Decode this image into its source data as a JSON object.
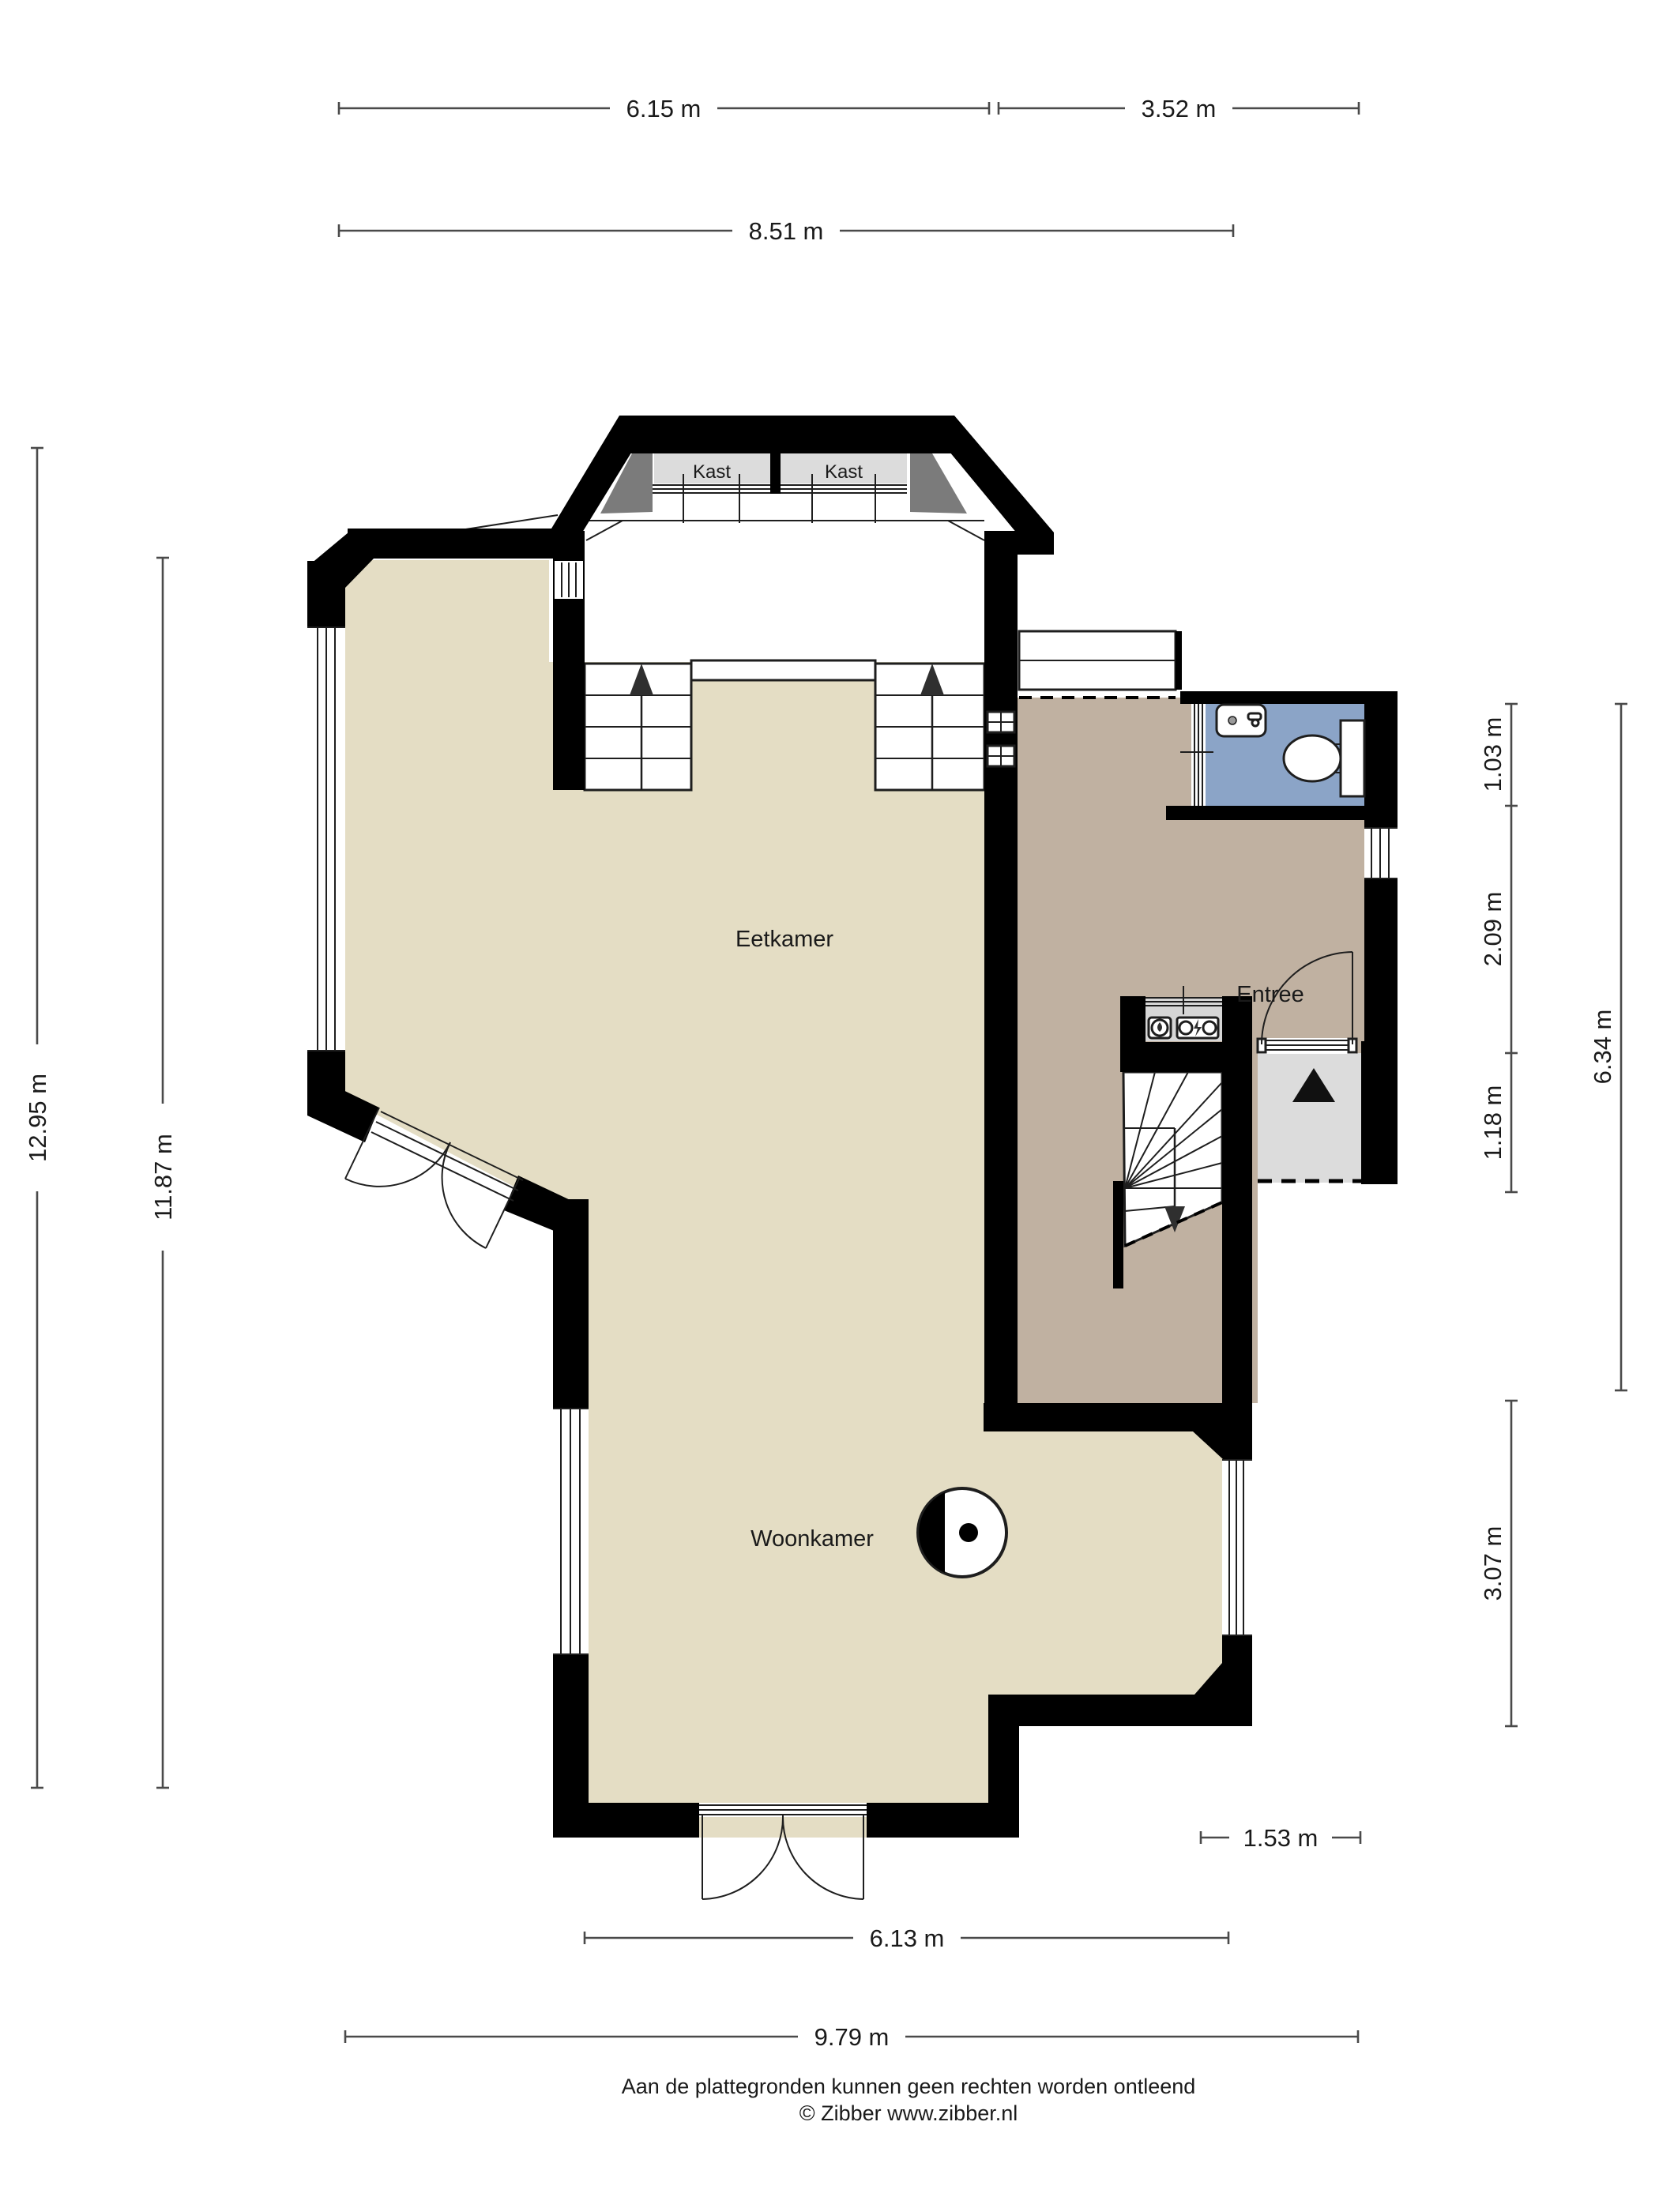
{
  "page": {
    "background": "#ffffff"
  },
  "floor_plan": {
    "rooms": [
      {
        "id": "kast-left",
        "label": "Kast"
      },
      {
        "id": "kast-right",
        "label": "Kast"
      },
      {
        "id": "eetkamer",
        "label": "Eetkamer"
      },
      {
        "id": "woonkamer",
        "label": "Woonkamer"
      },
      {
        "id": "entree",
        "label": "Entree"
      }
    ],
    "symbols": [
      "stairs-up-left",
      "stairs-up-right",
      "stairs-down-winder",
      "entrance-arrow",
      "front-door",
      "double-doors-south",
      "double-doors-diagonal",
      "toilet",
      "sink",
      "fireplace",
      "meter-cupboard",
      "windows",
      "ventilation-grilles"
    ]
  },
  "dimensions": {
    "top": [
      {
        "label": "6.15 m"
      },
      {
        "label": "3.52 m"
      }
    ],
    "top_total": {
      "label": "8.51 m"
    },
    "left": {
      "outer": {
        "label": "12.95 m"
      },
      "inner": {
        "label": "11.87 m"
      }
    },
    "right": {
      "segments": [
        {
          "label": "1.03 m"
        },
        {
          "label": "2.09 m"
        },
        {
          "label": "1.18 m"
        },
        {
          "label": "3.07 m"
        }
      ],
      "total": {
        "label": "6.34 m"
      }
    },
    "bottom": {
      "step": {
        "label": "1.53 m"
      },
      "inner": {
        "label": "6.13 m"
      },
      "total": {
        "label": "9.79 m"
      }
    }
  },
  "footer": {
    "disclaimer": "Aan de plattegronden kunnen geen rechten worden ontleend",
    "copyright": "© Zibber www.zibber.nl"
  },
  "colors": {
    "wall": "#000000",
    "floor_living": "#e4ddc4",
    "floor_hall": "#c0b1a1",
    "floor_toilet": "#8ba4c7",
    "closet": "#dcdcdc",
    "corner_window": "#7b7b7b",
    "porch": "#dcdcdc",
    "meter": "#d6d6d6",
    "dim": "#4a4a4a",
    "text": "#1a1a1a",
    "thin": "#1e1e1e"
  }
}
